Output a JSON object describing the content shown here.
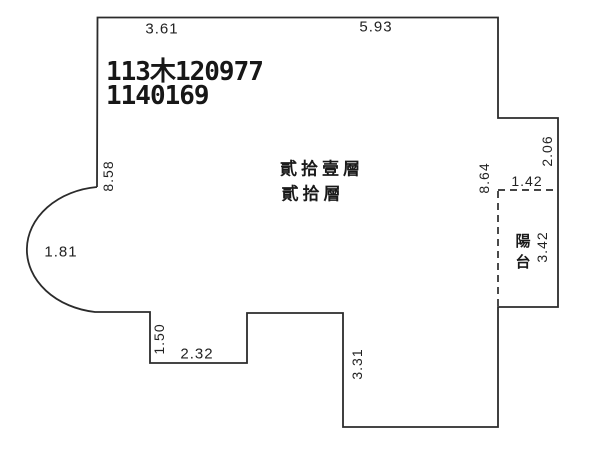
{
  "document": {
    "title_line1": "113木120977",
    "title_line2": "1140169"
  },
  "floor_labels": {
    "line1": "貳拾壹層",
    "line2": "貳拾層"
  },
  "room_labels": {
    "balcony": "陽台"
  },
  "dimensions": {
    "top_left_width": "3.61",
    "top_right_width": "5.93",
    "left_side_height": "8.58",
    "bay_radius": "1.81",
    "right_inner_height": "8.64",
    "balcony_width": "1.42",
    "right_upper_height": "2.06",
    "balcony_height": "3.42",
    "notch_depth": "1.50",
    "notch_width": "2.32",
    "lower_right_height": "3.31"
  },
  "colors": {
    "line": "#2b2b2b",
    "background": "#ffffff",
    "text": "#1e1e1e"
  }
}
